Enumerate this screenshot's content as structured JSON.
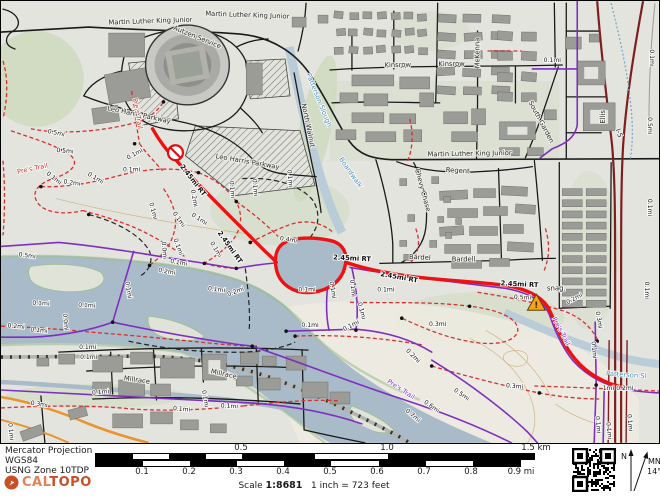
{
  "map": {
    "colors": {
      "route_red": "#ee1111",
      "trail_purple": "#7e2fc0",
      "trail_red_dashed": "#d63031",
      "water": "#a9bac8",
      "freeway_maroon": "#7d1f1f",
      "orange_road": "#e8952f",
      "warning_marker": "#f6a21d",
      "background": "#e4e4df"
    },
    "street_labels": [
      {
        "t": "Martin Luther King Junior",
        "x": 150,
        "y": 22,
        "r": -2
      },
      {
        "t": "Martin Luther King Junior",
        "x": 247,
        "y": 16,
        "r": 2
      },
      {
        "t": "Martin Luther King Junior",
        "x": 470,
        "y": 155,
        "r": -1
      },
      {
        "t": "Autzen Service",
        "x": 196,
        "y": 38,
        "r": 22
      },
      {
        "t": "Leo Harris Parkway",
        "x": 138,
        "y": 116,
        "r": 12
      },
      {
        "t": "Leo Harris Parkway",
        "x": 247,
        "y": 163,
        "r": 10
      },
      {
        "t": "North Walnut",
        "x": 306,
        "y": 125,
        "r": 78
      },
      {
        "t": "Kinsrow",
        "x": 398,
        "y": 66,
        "r": -1
      },
      {
        "t": "Kinsrow",
        "x": 452,
        "y": 65,
        "r": -1
      },
      {
        "t": "McKenna",
        "x": 480,
        "y": 52,
        "r": -90
      },
      {
        "t": "South Garden",
        "x": 540,
        "y": 122,
        "r": 62
      },
      {
        "t": "Regent",
        "x": 458,
        "y": 172,
        "r": 4
      },
      {
        "t": "Chevy Chase",
        "x": 421,
        "y": 190,
        "r": 75
      },
      {
        "t": "Bardel",
        "x": 420,
        "y": 259,
        "r": 3
      },
      {
        "t": "Bardell",
        "x": 464,
        "y": 261,
        "r": 0
      },
      {
        "t": "Millrace",
        "x": 136,
        "y": 382,
        "r": 8
      },
      {
        "t": "Millrace",
        "x": 223,
        "y": 376,
        "r": 12
      },
      {
        "t": "Ellis",
        "x": 606,
        "y": 116,
        "r": -90
      },
      {
        "t": "I-5",
        "x": 618,
        "y": 133,
        "r": 70
      }
    ],
    "water_labels": [
      {
        "t": "Patterson Slough",
        "x": 317,
        "y": 100,
        "r": 68
      },
      {
        "t": "Patterson Sl",
        "x": 627,
        "y": 377,
        "r": 4
      },
      {
        "t": "Boardwalk",
        "x": 349,
        "y": 173,
        "r": 55
      }
    ],
    "trail_labels": [
      {
        "t": "Pre's Trail",
        "x": 32,
        "y": 170,
        "r": -12,
        "c": "red"
      },
      {
        "t": "Pre's Trail",
        "x": 135,
        "y": 113,
        "r": 80,
        "c": "red"
      },
      {
        "t": "Pre's Trail",
        "x": 400,
        "y": 391,
        "r": 33,
        "c": "purple"
      },
      {
        "t": "Pre's Trail",
        "x": 560,
        "y": 332,
        "r": 62,
        "c": "purple"
      }
    ],
    "route_labels": [
      {
        "t": "2.45mi RT",
        "x": 191,
        "y": 181,
        "r": 52
      },
      {
        "t": "2.45mi RT",
        "x": 228,
        "y": 248,
        "r": 55
      },
      {
        "t": "2.45mi RT",
        "x": 352,
        "y": 260,
        "r": 3
      },
      {
        "t": "2.45mi RT",
        "x": 399,
        "y": 279,
        "r": 10
      },
      {
        "t": "2.45mi RT",
        "x": 520,
        "y": 286,
        "r": 3
      }
    ],
    "marker_labels": [
      {
        "t": "snag.",
        "x": 557,
        "y": 290,
        "r": 0
      }
    ],
    "distance_labels": [
      {
        "t": "0.5mi",
        "x": 55,
        "y": 134,
        "r": 12
      },
      {
        "t": "0.5mi",
        "x": 64,
        "y": 152,
        "r": 5
      },
      {
        "t": "0.1mi",
        "x": 135,
        "y": 155,
        "r": -28
      },
      {
        "t": "0.1mi",
        "x": 131,
        "y": 171,
        "r": 0
      },
      {
        "t": "0.1mi",
        "x": 52,
        "y": 179,
        "r": 38
      },
      {
        "t": "0.2mi",
        "x": 71,
        "y": 184,
        "r": 8
      },
      {
        "t": "0.1mi",
        "x": 94,
        "y": 179,
        "r": 30
      },
      {
        "t": "0.5mi",
        "x": 26,
        "y": 257,
        "r": 8
      },
      {
        "t": "0.1mi",
        "x": 151,
        "y": 211,
        "r": 75
      },
      {
        "t": "0.2mi",
        "x": 192,
        "y": 198,
        "r": 80
      },
      {
        "t": "0.1mi",
        "x": 177,
        "y": 220,
        "r": 55
      },
      {
        "t": "0.1mi",
        "x": 198,
        "y": 220,
        "r": 33
      },
      {
        "t": "0.1mi",
        "x": 176,
        "y": 247,
        "r": 70
      },
      {
        "t": "0.1mi",
        "x": 214,
        "y": 250,
        "r": 60
      },
      {
        "t": "0.0mi",
        "x": 162,
        "y": 250,
        "r": 85
      },
      {
        "t": "0.1mi",
        "x": 230,
        "y": 189,
        "r": 85
      },
      {
        "t": "0.1mi",
        "x": 253,
        "y": 187,
        "r": 85
      },
      {
        "t": "0.1mi",
        "x": 288,
        "y": 178,
        "r": 85
      },
      {
        "t": "0.4mi",
        "x": 288,
        "y": 241,
        "r": 10
      },
      {
        "t": "0.1mi",
        "x": 307,
        "y": 291,
        "r": 0
      },
      {
        "t": "0.1mi",
        "x": 331,
        "y": 290,
        "r": 80
      },
      {
        "t": "0.1mi",
        "x": 351,
        "y": 288,
        "r": 85
      },
      {
        "t": "0.1mi",
        "x": 386,
        "y": 291,
        "r": 0
      },
      {
        "t": "0.1mi",
        "x": 360,
        "y": 311,
        "r": 75
      },
      {
        "t": "0.1mi",
        "x": 310,
        "y": 327,
        "r": 0
      },
      {
        "t": "0.1mi",
        "x": 352,
        "y": 327,
        "r": -28
      },
      {
        "t": "0.3mi",
        "x": 438,
        "y": 326,
        "r": 0
      },
      {
        "t": "0.1mi",
        "x": 553,
        "y": 61,
        "r": 0
      },
      {
        "t": "0.2mi",
        "x": 576,
        "y": 300,
        "r": -28
      },
      {
        "t": "0.5mi",
        "x": 523,
        "y": 299,
        "r": 3
      },
      {
        "t": "0.3mi",
        "x": 598,
        "y": 320,
        "r": 80
      },
      {
        "t": "0.1mi",
        "x": 593,
        "y": 350,
        "r": 85
      },
      {
        "t": "1mi 0.2mi",
        "x": 619,
        "y": 390,
        "r": 0
      },
      {
        "t": "0.3mi",
        "x": 515,
        "y": 388,
        "r": 5
      },
      {
        "t": "0.2mi",
        "x": 412,
        "y": 357,
        "r": 45
      },
      {
        "t": "0.6mi",
        "x": 431,
        "y": 408,
        "r": 35
      },
      {
        "t": "0.5mi",
        "x": 461,
        "y": 396,
        "r": 35
      },
      {
        "t": "0.7mi",
        "x": 412,
        "y": 417,
        "r": 40
      },
      {
        "t": "0.1mi",
        "x": 178,
        "y": 264,
        "r": 10
      },
      {
        "t": "0.2mi",
        "x": 166,
        "y": 273,
        "r": 10
      },
      {
        "t": "0.1mi",
        "x": 216,
        "y": 291,
        "r": 8
      },
      {
        "t": "0.1mi",
        "x": 126,
        "y": 290,
        "r": 80
      },
      {
        "t": "0.2mi",
        "x": 236,
        "y": 293,
        "r": -20
      },
      {
        "t": "0.2mi",
        "x": 15,
        "y": 328,
        "r": 5
      },
      {
        "t": "0.1mi",
        "x": 38,
        "y": 332,
        "r": 5
      },
      {
        "t": "0.0mi",
        "x": 63,
        "y": 322,
        "r": 85
      },
      {
        "t": "0.1mi",
        "x": 40,
        "y": 305,
        "r": 3
      },
      {
        "t": "0.1mi",
        "x": 86,
        "y": 307,
        "r": 3
      },
      {
        "t": "0.1mi",
        "x": 87,
        "y": 349,
        "r": 0
      },
      {
        "t": "0.1mi",
        "x": 88,
        "y": 359,
        "r": 0
      },
      {
        "t": "0.3mi",
        "x": 38,
        "y": 406,
        "r": 8
      },
      {
        "t": "0.1mi",
        "x": 100,
        "y": 394,
        "r": -5
      },
      {
        "t": "0.1mi",
        "x": 181,
        "y": 411,
        "r": 5
      },
      {
        "t": "0.1mi",
        "x": 229,
        "y": 408,
        "r": 3
      },
      {
        "t": "0.1mi",
        "x": 203,
        "y": 399,
        "r": 80
      },
      {
        "t": "0.1mi",
        "x": 8,
        "y": 432,
        "r": 85
      },
      {
        "t": "0.1mi",
        "x": 651,
        "y": 57,
        "r": 90
      },
      {
        "t": "0.5mi",
        "x": 649,
        "y": 125,
        "r": 90
      },
      {
        "t": "0.1mi",
        "x": 649,
        "y": 207,
        "r": 90
      },
      {
        "t": "0.1mi",
        "x": 646,
        "y": 290,
        "r": 90
      },
      {
        "t": "0.1mi",
        "x": 597,
        "y": 425,
        "r": 85
      },
      {
        "t": "0.1mi",
        "x": 608,
        "y": 431,
        "r": 85
      },
      {
        "t": "0.1mi",
        "x": 629,
        "y": 423,
        "r": 85
      }
    ],
    "warning_marker_text": "!"
  },
  "footer": {
    "projection": "Mercator Projection",
    "datum": "WGS84",
    "zone": "USNG Zone 10TDP",
    "logo_cal": "CALTOPO",
    "scale_word": "Scale",
    "scale_value": "1:8681",
    "equivalence": "1 inch = 723 feet",
    "km_ticks": [
      "0.5",
      "1.0",
      "1.5 km"
    ],
    "mi_ticks": [
      "0.1",
      "0.2",
      "0.3",
      "0.4",
      "0.5",
      "0.6",
      "0.7",
      "0.8",
      "0.9 mi"
    ],
    "north_n": "N",
    "north_mn": "MN",
    "declination": "14°"
  }
}
